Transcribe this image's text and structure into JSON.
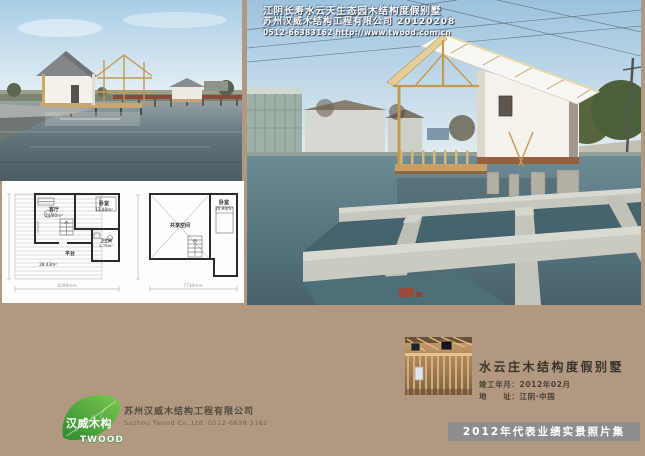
{
  "colors": {
    "page-bg": "#b19881",
    "banner-bg": "#8d8d8d",
    "logo-green": "#3f9e35"
  },
  "main_photo": {
    "caption_line1": "江阴长寿水云天生态园木结构度假别墅",
    "caption_line2": "苏州汉威木结构工程有限公司  20120208",
    "caption_line3": "0512-66383162 http://www.twood.com.cn"
  },
  "floorplan": {
    "plan1": {
      "living_label": "客厅",
      "living_area": "24.80m²",
      "bedroom_label": "卧室",
      "bedroom_area": "11.48m²",
      "bath_label": "卫生间",
      "bath_area": "4.78m²",
      "deck_label": "平台",
      "deck_area": "28.43m²",
      "width_dim": "8290mm"
    },
    "plan2": {
      "shared_label": "共享空间",
      "bedroom_label": "卧室",
      "bedroom_area": "20.90m²",
      "width_dim": "7730mm"
    }
  },
  "logo": {
    "name_cn": "汉威木构",
    "name_en": "TWOOD",
    "company_cn": "苏州汉威木结构工程有限公司",
    "company_en": "Suzhou Twood Co.,Ltd.  0512-6638 3162"
  },
  "project": {
    "title": "水云庄木结构度假别墅",
    "completion": "竣工年月：2012年02月",
    "address": "地　　址：江阴·中国"
  },
  "footer": {
    "banner": "2012年代表业绩实景照片集"
  }
}
